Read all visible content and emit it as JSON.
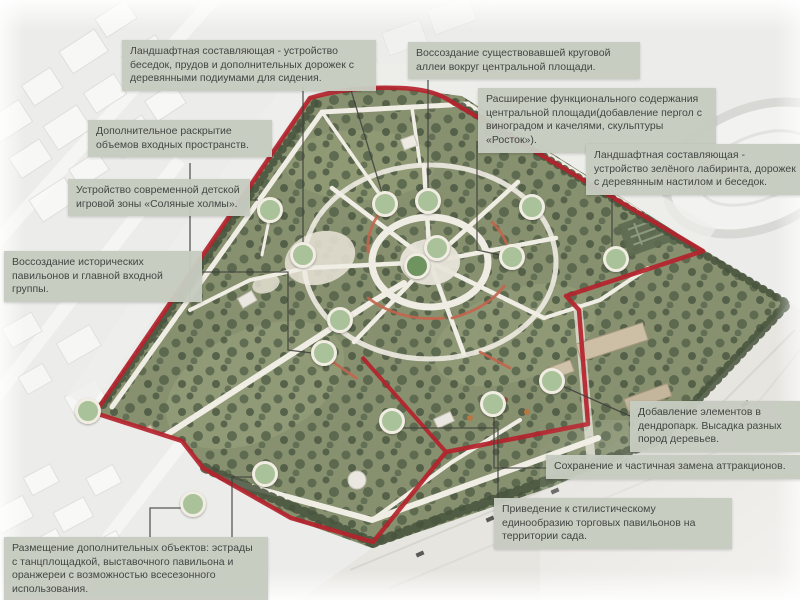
{
  "colors": {
    "boundary_red": "#b5232c",
    "marker_fill": "#a9c29a",
    "marker_fill_dark": "#6f9460",
    "marker_border": "#f1ede3",
    "note_bg": "#c7ccc1",
    "note_text": "#3b403c"
  },
  "annotations": [
    {
      "text": "Ландшафтная составляющая - устройство беседок, прудов и дополнительных дорожек с деревянными подиумами для сидения."
    },
    {
      "text": "Воссоздание существовавшей круговой аллеи вокруг центральной площади."
    },
    {
      "text": "Расширение функционального содержания центральной площади(добавление пергол с виноградом и качелями, скульптуры «Росток»)."
    },
    {
      "text": "Ландшафтная составляющая - устройство зелёного лабиринта, дорожек с деревянным настилом и беседок."
    },
    {
      "text": "Дополнительное раскрытие объемов входных пространств."
    },
    {
      "text": "Устройство современной детской игровой зоны «Соляные холмы»."
    },
    {
      "text": "Воссоздание исторических павильонов и главной входной группы."
    },
    {
      "text": "Добавление элементов в дендропарк. Высадка разных пород деревьев."
    },
    {
      "text": "Сохранение и частичная замена аттракционов."
    },
    {
      "text": "Приведение к стилистическому единообразию торговых павильонов на территории сада."
    },
    {
      "text": "Размещение дополнительных объектов: эстрады с танцплощадкой, выставочного павильона и оранжереи с возможностью всесезонного использования."
    }
  ],
  "map": {
    "markers": [
      {
        "x": 88,
        "y": 411
      },
      {
        "x": 270,
        "y": 210
      },
      {
        "x": 303,
        "y": 255
      },
      {
        "x": 385,
        "y": 204
      },
      {
        "x": 428,
        "y": 201
      },
      {
        "x": 437,
        "y": 248
      },
      {
        "x": 417,
        "y": 266,
        "tone": "dark"
      },
      {
        "x": 532,
        "y": 207
      },
      {
        "x": 512,
        "y": 257
      },
      {
        "x": 616,
        "y": 259
      },
      {
        "x": 340,
        "y": 320
      },
      {
        "x": 324,
        "y": 353
      },
      {
        "x": 392,
        "y": 421
      },
      {
        "x": 493,
        "y": 404
      },
      {
        "x": 552,
        "y": 381
      },
      {
        "x": 265,
        "y": 474
      },
      {
        "x": 193,
        "y": 504
      }
    ]
  }
}
